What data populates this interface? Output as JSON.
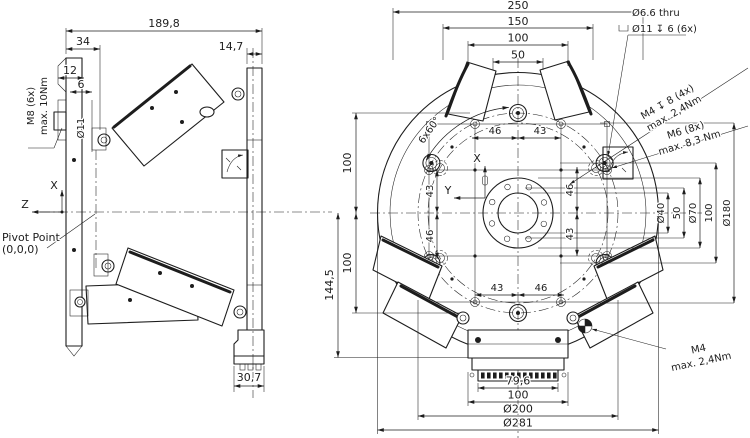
{
  "colors": {
    "ink": "#1d1d1d",
    "background": "#ffffff"
  },
  "side_view": {
    "dims": {
      "overall_width": "189,8",
      "flange_offset": "34",
      "plate_thickness": "14,7",
      "step_12": "12",
      "step_6": "6",
      "hole_diameter": "Ø11",
      "foot_width": "30,7"
    },
    "thread_callout": {
      "line1": "M8 (6x)",
      "line2": "max. 10Nm"
    },
    "axes": {
      "x": "X",
      "z": "Z"
    },
    "pivot": {
      "line1": "Pivot Point",
      "line2": "(0,0,0)"
    }
  },
  "front_view": {
    "top_dims": {
      "outer": "250",
      "d150": "150",
      "d100": "100",
      "d50": "50"
    },
    "left_dims": {
      "upper": "100",
      "lower": "100",
      "overall": "144,5"
    },
    "right_dims": {
      "bore": "Ø40",
      "square": "50",
      "boss": "Ø70",
      "pattern": "100",
      "bolt_circle": "Ø180"
    },
    "inner_dims": {
      "top_left": "46",
      "top_right": "43",
      "bottom_left": "43",
      "bottom_right": "46",
      "left_upper": "43",
      "left_lower": "46",
      "right_upper": "46",
      "right_lower": "43"
    },
    "bottom_dims": {
      "connector": "79,6",
      "housing": "100",
      "bolt_circle": "Ø200",
      "outer": "Ø281"
    },
    "callouts": {
      "counterbore_line1": "Ø6.6 thru",
      "counterbore_line2": "Ø11 ↧ 6 (6x)",
      "m4_pattern_line1": "M4 ↧ 8 (4x)",
      "m4_pattern_line2": "max. 2,4Nm",
      "m6_line1": "M6 (8x)",
      "m6_line2": "max. 8,3 Nm",
      "m4_ground_line1": "M4",
      "m4_ground_line2": "max. 2,4Nm",
      "hole_spacing_angle": "6x60°"
    },
    "axes": {
      "x": "X",
      "y": "Y"
    }
  }
}
